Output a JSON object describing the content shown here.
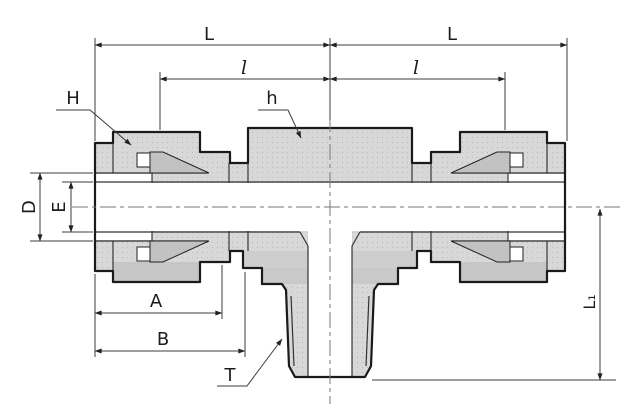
{
  "figure": {
    "type": "technical-drawing",
    "subject": "male branch tee compression tube fitting, sectioned side view",
    "labels": {
      "length_left": "L",
      "length_right": "L",
      "sub_length_left": "l",
      "sub_length_right": "l",
      "nut_hex": "H",
      "body_hex": "h",
      "hole_diameter": "D",
      "bore_diameter": "E",
      "nut_length": "A",
      "body_length": "B",
      "thread": "T",
      "branch_height": "L₁"
    },
    "colors": {
      "outline": "#1a1a1a",
      "metal_fill": "#d8d8d8",
      "metal_shade": "#c6c6c6",
      "ferrule_fill": "#c2c2c2",
      "dimension_line": "#3c3c3c",
      "centerline": "#777777",
      "background": "#ffffff"
    }
  }
}
